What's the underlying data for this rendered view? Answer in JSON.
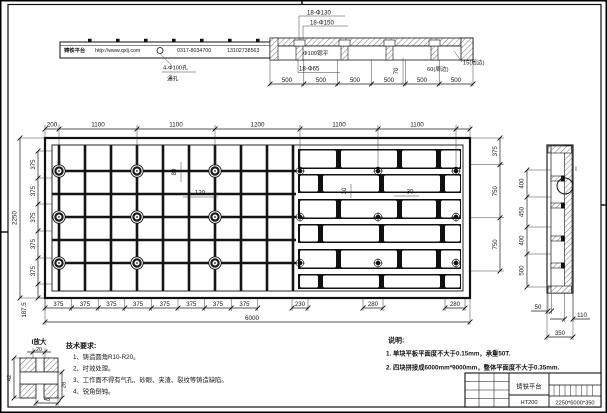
{
  "elevation": {
    "brand": "铸铁平台",
    "website": "http://www.qxlj.com",
    "phone": "0317-8034700",
    "mobile": "13102738563",
    "hole_callout_top": "4-Φ100孔",
    "hole_callout_bottom": "通孔"
  },
  "section": {
    "callout_d130": "18-Φ130",
    "callout_d150": "18-Φ150",
    "callout_spotface": "Φ100锪平",
    "callout_d65": "18-Φ65",
    "dim_70": "70",
    "dim_edge_60": "60(周边)",
    "dim_edge_15": "15(周边)",
    "pitch": [
      "500",
      "500",
      "500",
      "500",
      "500",
      "500"
    ]
  },
  "plan": {
    "top_dims": [
      "200",
      "1100",
      "1100",
      "1200",
      "1100",
      "1100"
    ],
    "bottom_dims": [
      "375",
      "375",
      "375",
      "375",
      "375",
      "375",
      "375",
      "375"
    ],
    "pocket_dims": [
      "230",
      "280",
      "280"
    ],
    "total_width": "6000",
    "left_total": "2250",
    "left_dims": [
      "375",
      "375",
      "375",
      "375",
      "375"
    ],
    "left_margin": "187.5",
    "right_dims": [
      "375",
      "750",
      "750"
    ],
    "dim_80": "80",
    "dim_120": "120",
    "dim_30_vert": "30",
    "dim_30_horiz": "30"
  },
  "side": {
    "dims": [
      "400",
      "450",
      "400",
      "500"
    ],
    "dim_50": "50",
    "dim_110": "110",
    "dim_350": "350",
    "detail_mark": "I"
  },
  "detail": {
    "title": "I放大",
    "dim_top": "20",
    "dim_left": "42",
    "dim_right": "28",
    "dim_bottom": "45"
  },
  "tech": {
    "title": "技术要求:",
    "items": [
      "1、铸造圆角R10-R20。",
      "2、时效处理。",
      "3、工作面不得有气孔、砂眼、夹渣、裂纹等铸造缺陷。",
      "4、锐角倒钝。"
    ]
  },
  "notes": {
    "title": "说明:",
    "items": [
      "1. 单块平板平面度不大于0.15mm，承重50T.",
      "2. 四块拼接成6000mm*9000mm，整体平面度不大于0.35mm."
    ]
  },
  "titleblock": {
    "part_name": "铸铁平台",
    "material": "HT200",
    "size": "2250*6000*350"
  },
  "colors": {
    "line": "#1a1a1a",
    "bg": "#ffffff"
  }
}
